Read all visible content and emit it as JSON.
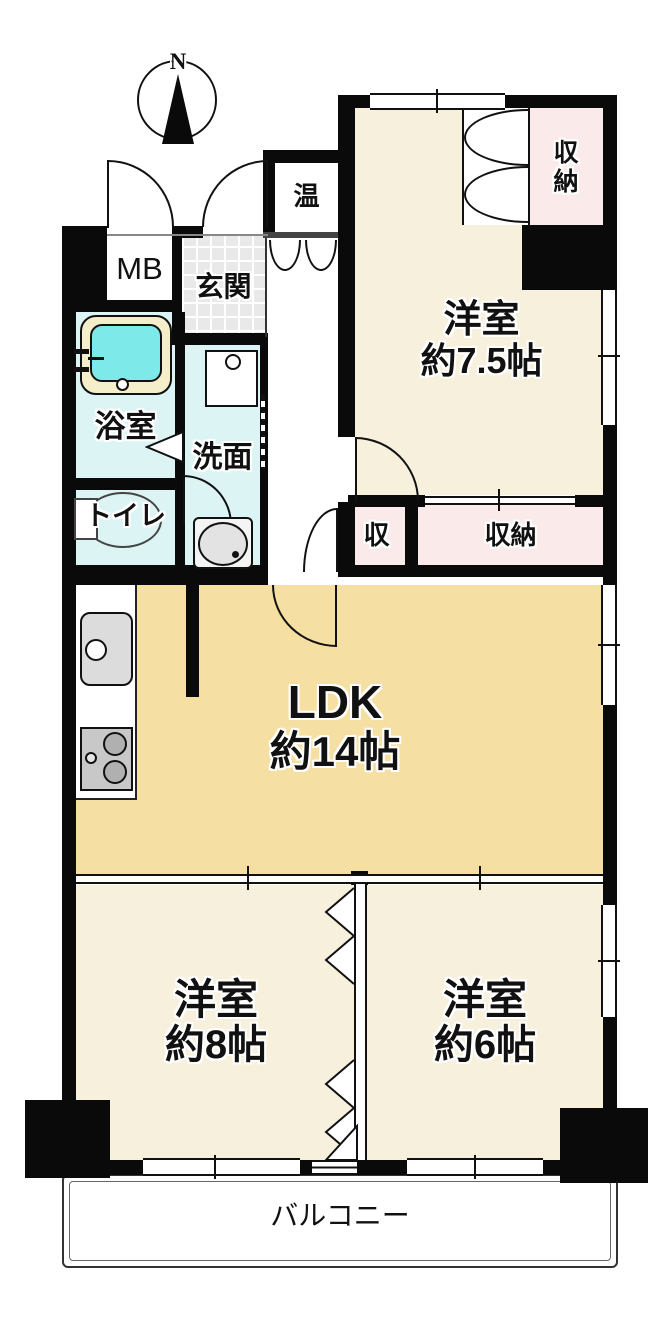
{
  "compass": {
    "north_label": "N"
  },
  "rooms": {
    "hot_water": {
      "label": "温"
    },
    "meter_box": {
      "label": "MB"
    },
    "entrance": {
      "label": "玄関"
    },
    "closet_top_right": {
      "label": "収納"
    },
    "western_room_7_5": {
      "label": "洋室",
      "size": "約7.5帖"
    },
    "bathroom": {
      "label": "浴室"
    },
    "washroom": {
      "label": "洗面"
    },
    "toilet": {
      "label": "トイレ"
    },
    "storage_small": {
      "label": "収"
    },
    "storage_wide": {
      "label": "収納"
    },
    "ldk": {
      "label": "LDK",
      "size": "約14帖"
    },
    "western_room_8": {
      "label": "洋室",
      "size": "約8帖"
    },
    "western_room_6": {
      "label": "洋室",
      "size": "約6帖"
    },
    "balcony": {
      "label": "バルコニー"
    }
  },
  "colors": {
    "wall": "#0a0a0a",
    "line": "#111111",
    "western-room": "#f7f0dd",
    "ldk": "#f6dfa2",
    "closet": "#fbeaea",
    "wet-room": "#dcf4f4",
    "bath-water": "#7de9e9",
    "tub-rim": "#f5eecb",
    "tile": "#e9e9e9"
  }
}
